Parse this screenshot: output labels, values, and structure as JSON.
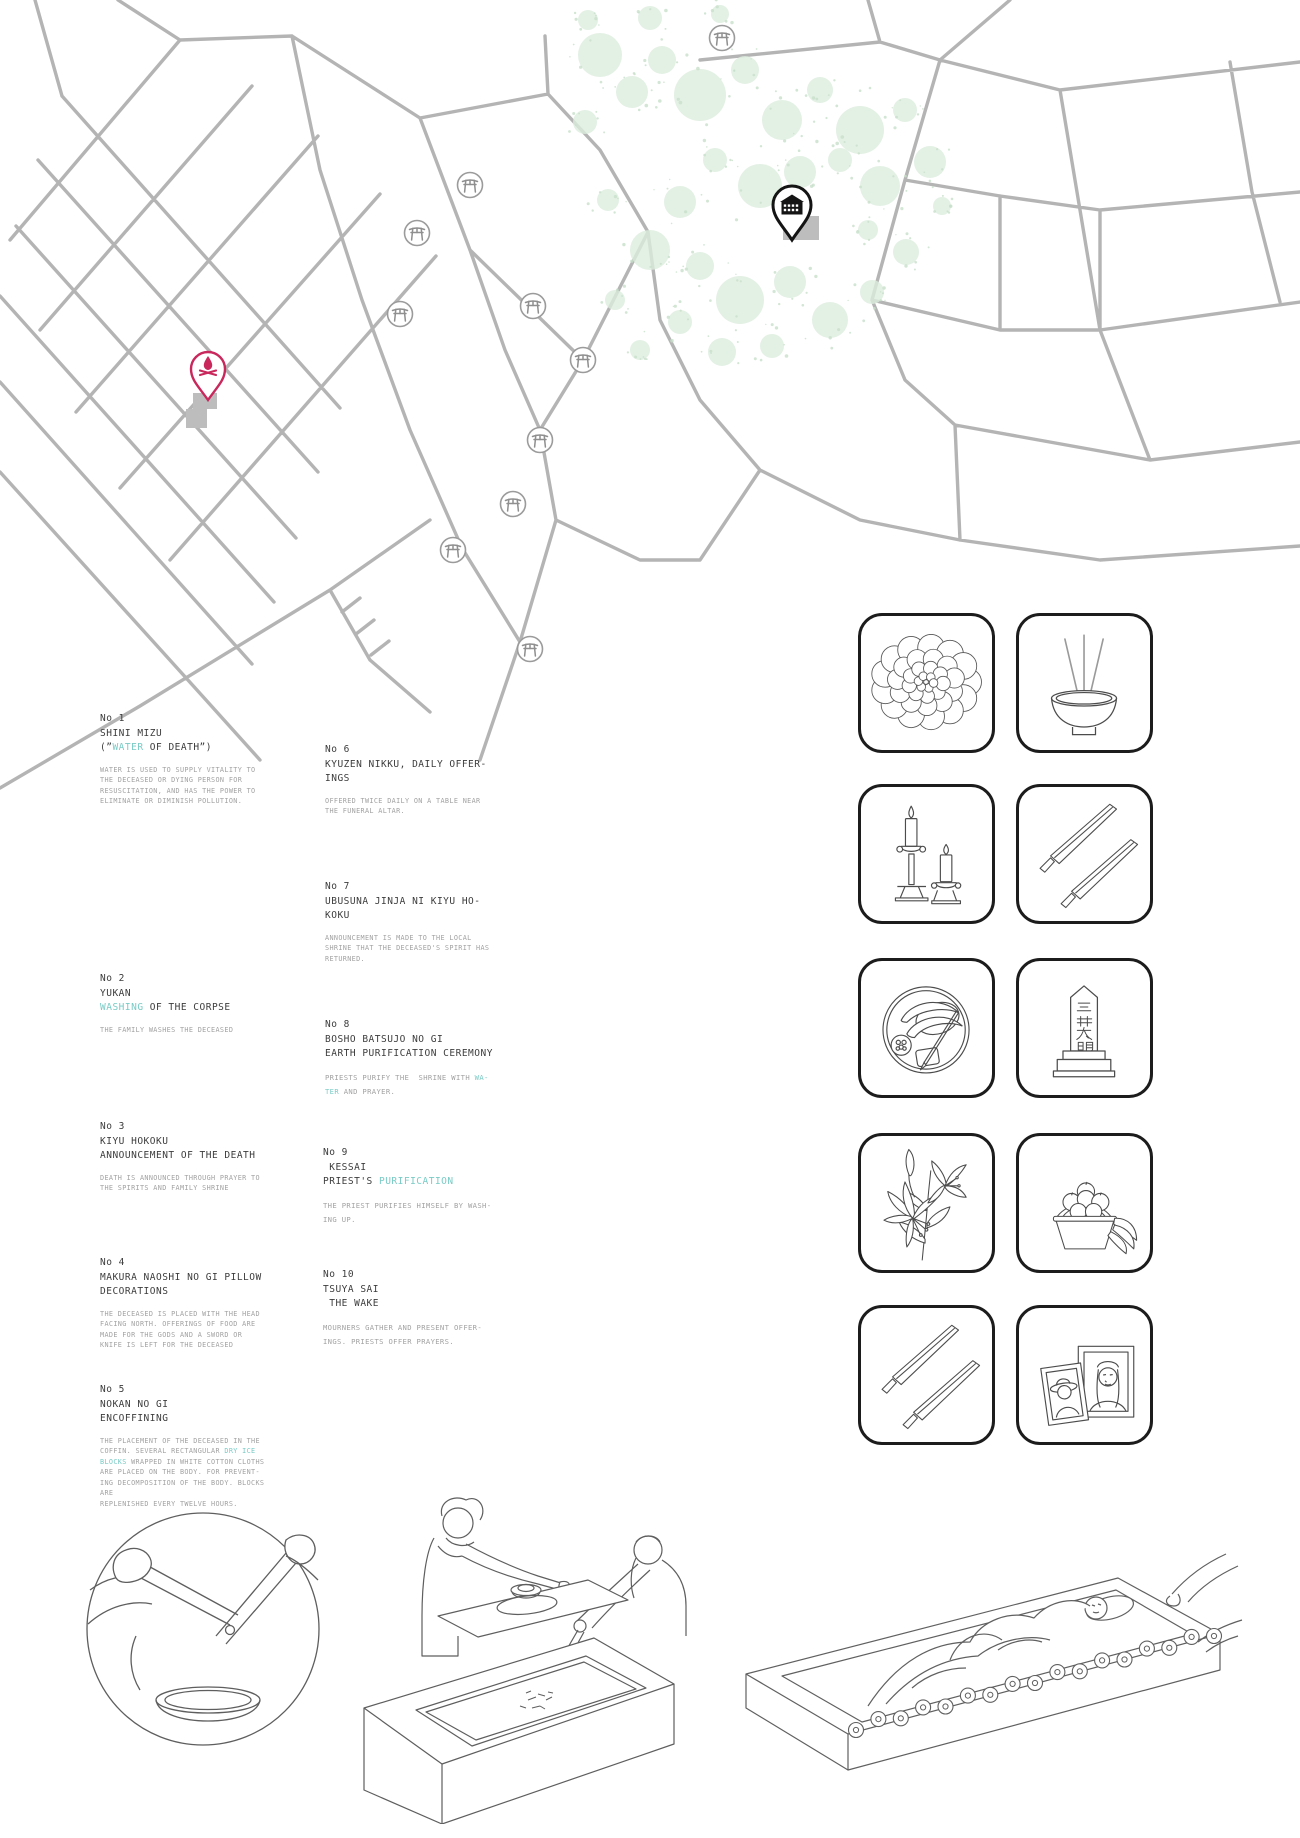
{
  "colors": {
    "accent_teal": "#79cbc6",
    "pin_pink": "#c9285d",
    "pin_black": "#141414",
    "road_gray": "#b4b4b4",
    "tree_green": "#dcecdd",
    "heading_text": "#3c3c3c",
    "body_text": "#a2a2a2"
  },
  "map": {
    "torii_icon": "torii-gate-icon",
    "torii_count": 10,
    "pins": [
      {
        "name": "cremation-site-pin",
        "icon": "bonfire-icon",
        "color": "#c9285d"
      },
      {
        "name": "funeral-hall-pin",
        "icon": "hall-building-icon",
        "color": "#141414"
      }
    ]
  },
  "steps": [
    {
      "no": "No 1",
      "title": [
        [
          {
            "t": "SHINI MIZU"
          }
        ],
        [
          {
            "t": "(”"
          },
          {
            "t": "WATER",
            "hl": true
          },
          {
            "t": " OF DEATH”)"
          }
        ]
      ],
      "body": [
        [
          {
            "t": "WATER IS USED TO SUPPLY VITALITY TO"
          }
        ],
        [
          {
            "t": "THE DECEASED OR DYING PERSON FOR"
          }
        ],
        [
          {
            "t": "RESUSCITATION, AND HAS THE POWER TO"
          }
        ],
        [
          {
            "t": "ELIMINATE OR DIMINISH POLLUTION."
          }
        ]
      ]
    },
    {
      "no": "No 2",
      "title": [
        [
          {
            "t": "YUKAN"
          }
        ],
        [
          {
            "t": "WASHING",
            "hl": true
          },
          {
            "t": " OF THE CORPSE"
          }
        ]
      ],
      "body": [
        [
          {
            "t": "THE FAMILY WASHES THE DECEASED"
          }
        ]
      ]
    },
    {
      "no": "No 3",
      "title": [
        [
          {
            "t": "KIYU HOKOKU"
          }
        ],
        [
          {
            "t": "ANNOUNCEMENT OF THE DEATH"
          }
        ]
      ],
      "body": [
        [
          {
            "t": "DEATH IS ANNOUNCED THROUGH PRAYER TO"
          }
        ],
        [
          {
            "t": "THE SPIRITS AND FAMILY SHRINE"
          }
        ]
      ]
    },
    {
      "no": "No 4",
      "title": [
        [
          {
            "t": "MAKURA NAOSHI NO GI PILLOW"
          }
        ],
        [
          {
            "t": "DECORATIONS"
          }
        ]
      ],
      "body": [
        [
          {
            "t": "THE DECEASED IS PLACED WITH THE HEAD"
          }
        ],
        [
          {
            "t": "FACING NORTH. OFFERINGS OF FOOD ARE"
          }
        ],
        [
          {
            "t": "MADE FOR THE GODS AND A SWORD OR"
          }
        ],
        [
          {
            "t": "KNIFE IS LEFT FOR THE DECEASED"
          }
        ]
      ]
    },
    {
      "no": "No 5",
      "title": [
        [
          {
            "t": "NOKAN NO GI"
          }
        ],
        [
          {
            "t": "ENCOFFINING"
          }
        ]
      ],
      "body": [
        [
          {
            "t": "THE PLACEMENT OF THE DECEASED IN THE"
          }
        ],
        [
          {
            "t": "COFFIN. SEVERAL RECTANGULAR "
          },
          {
            "t": "DRY ICE",
            "hl": true
          }
        ],
        [
          {
            "t": "BLOCKS",
            "hl": true
          },
          {
            "t": " WRAPPED IN WHITE COTTON CLOTHS"
          }
        ],
        [
          {
            "t": "ARE PLACED ON THE BODY. FOR PREVENT-"
          }
        ],
        [
          {
            "t": "ING DECOMPOSITION OF THE BODY. BLOCKS"
          }
        ],
        [
          {
            "t": "ARE"
          }
        ],
        [
          {
            "t": "REPLENISHED EVERY TWELVE HOURS."
          }
        ]
      ]
    },
    {
      "no": "No 6",
      "title": [
        [
          {
            "t": "KYUZEN NIKKU, DAILY OFFER-"
          }
        ],
        [
          {
            "t": "INGS"
          }
        ]
      ],
      "body": [
        [
          {
            "t": "OFFERED TWICE DAILY ON A TABLE NEAR"
          }
        ],
        [
          {
            "t": "THE FUNERAL ALTAR."
          }
        ]
      ]
    },
    {
      "no": "No 7",
      "title": [
        [
          {
            "t": "UBUSUNA JINJA NI KIYU HO-"
          }
        ],
        [
          {
            "t": "KOKU"
          }
        ]
      ],
      "body": [
        [
          {
            "t": "ANNOUNCEMENT IS MADE TO THE LOCAL"
          }
        ],
        [
          {
            "t": "SHRINE THAT THE DECEASED'S SPIRIT HAS"
          }
        ],
        [
          {
            "t": "RETURNED."
          }
        ]
      ]
    },
    {
      "no": "No 8",
      "title": [
        [
          {
            "t": "BOSHO BATSUJO NO GI"
          }
        ],
        [
          {
            "t": "EARTH PURIFICATION CEREMONY"
          }
        ]
      ],
      "body": [
        [
          {
            "t": "PRIESTS PURIFY THE  SHRINE WITH "
          },
          {
            "t": "WA-",
            "hl": true
          }
        ],
        [
          {
            "t": "TER",
            "hl": true
          },
          {
            "t": " AND PRAYER."
          }
        ]
      ]
    },
    {
      "no": "No 9",
      "title": [
        [
          {
            "t": " KESSAI"
          }
        ],
        [
          {
            "t": "PRIEST'S "
          },
          {
            "t": "PURIFICATION",
            "hl": true
          }
        ]
      ],
      "body": [
        [
          {
            "t": "THE PRIEST PURIFIES HIMSELF BY WASH-"
          }
        ],
        [
          {
            "t": "ING UP."
          }
        ]
      ]
    },
    {
      "no": "No 10",
      "title": [
        [
          {
            "t": "TSUYA SAI"
          }
        ],
        [
          {
            "t": " THE WAKE"
          }
        ]
      ],
      "body": [
        [
          {
            "t": "MOURNERS GATHER AND PRESENT OFFER-"
          }
        ],
        [
          {
            "t": "INGS. PRIESTS OFFER PRAYERS."
          }
        ]
      ]
    }
  ],
  "ritual_icons": [
    {
      "name": "chrysanthemum-icon"
    },
    {
      "name": "incense-bowl-icon"
    },
    {
      "name": "candlesticks-icon"
    },
    {
      "name": "ritual-knives-icon"
    },
    {
      "name": "offering-tray-icon"
    },
    {
      "name": "grave-marker-icon",
      "characters": [
        "三",
        "井",
        "太",
        "朗"
      ]
    },
    {
      "name": "lily-icon"
    },
    {
      "name": "fruit-basket-icon"
    },
    {
      "name": "ritual-knives-icon"
    },
    {
      "name": "memorial-portraits-icon"
    }
  ],
  "illustrations": [
    {
      "name": "kotsuage-chopsticks-closeup"
    },
    {
      "name": "bone-picking-ceremony-table"
    },
    {
      "name": "encoffined-body-with-flowers"
    }
  ]
}
